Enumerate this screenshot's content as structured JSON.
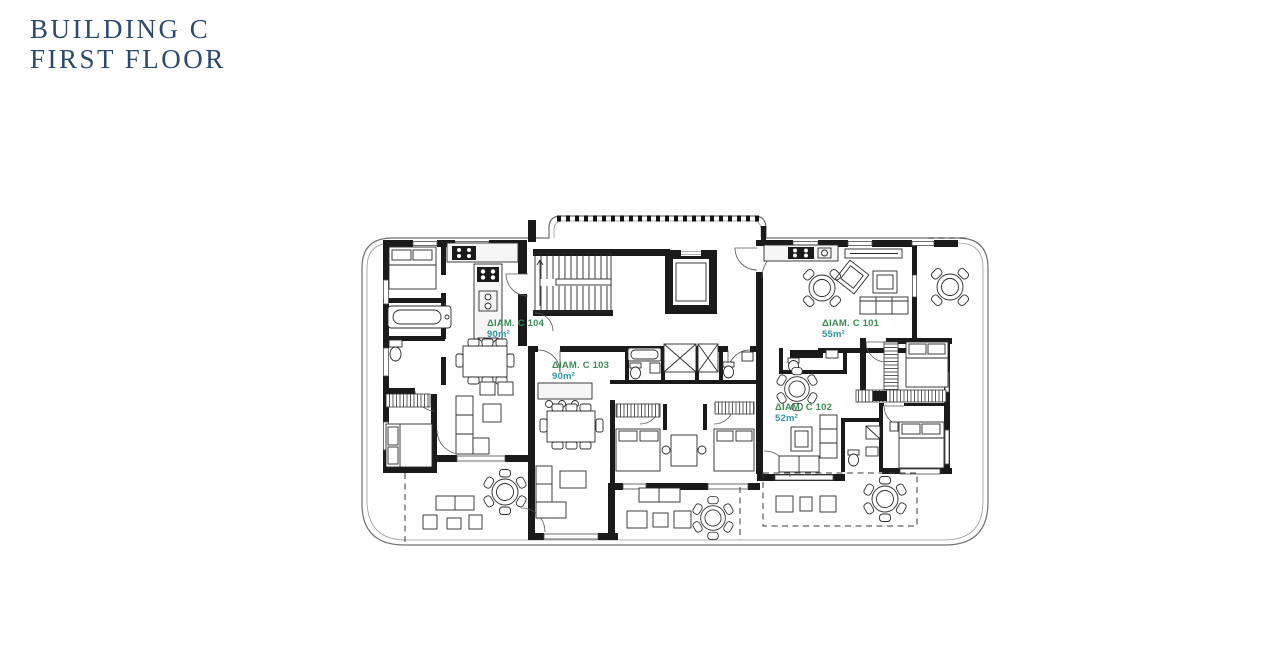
{
  "header": {
    "title_line1": "BUILDING C",
    "title_line2": "FIRST FLOOR",
    "title_color": "#2b4a6d"
  },
  "plan": {
    "apartments": [
      {
        "id": "C104",
        "name": "ΔΙΑΜ. C 104",
        "area": "90m²"
      },
      {
        "id": "C103",
        "name": "ΔΙΑΜ. C 103",
        "area": "90m²"
      },
      {
        "id": "C101",
        "name": "ΔΙΑΜ. C 101",
        "area": "55m²"
      },
      {
        "id": "C102",
        "name": "ΔΙΑΜ. C 102",
        "area": "52m²"
      }
    ],
    "name_color": "#3a8c55",
    "area_color": "#2f94a4",
    "wall_color": "#1a1a1a"
  }
}
